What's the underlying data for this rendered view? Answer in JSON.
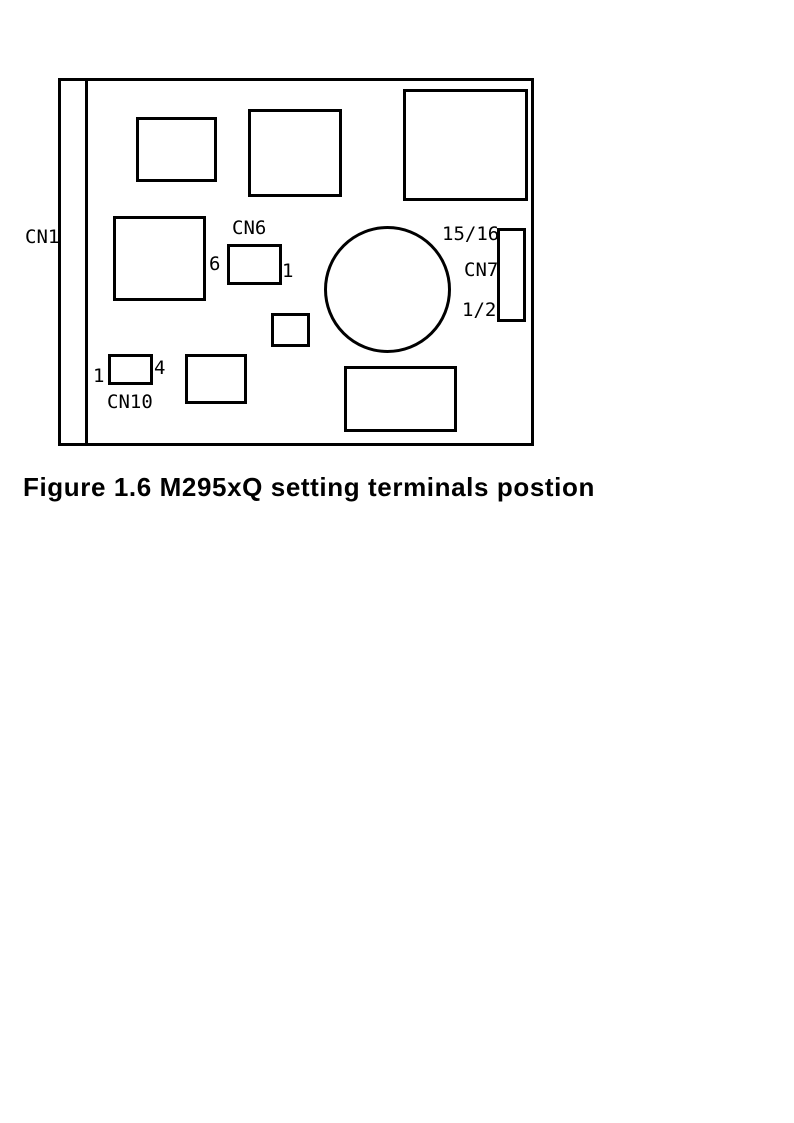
{
  "figure": {
    "caption": "Figure 1.6 M295xQ setting terminals postion"
  },
  "board": {
    "connectors": {
      "cn1": {
        "label": "CN1"
      },
      "cn6": {
        "label": "CN6",
        "pin_left": "6",
        "pin_right": "1"
      },
      "cn7": {
        "label": "CN7",
        "pin_top": "15/16",
        "pin_bottom": "1/2"
      },
      "cn10": {
        "label": "CN10",
        "pin_left": "1",
        "pin_right": "4"
      }
    },
    "colors": {
      "ink": "#000000",
      "background": "#ffffff"
    }
  }
}
